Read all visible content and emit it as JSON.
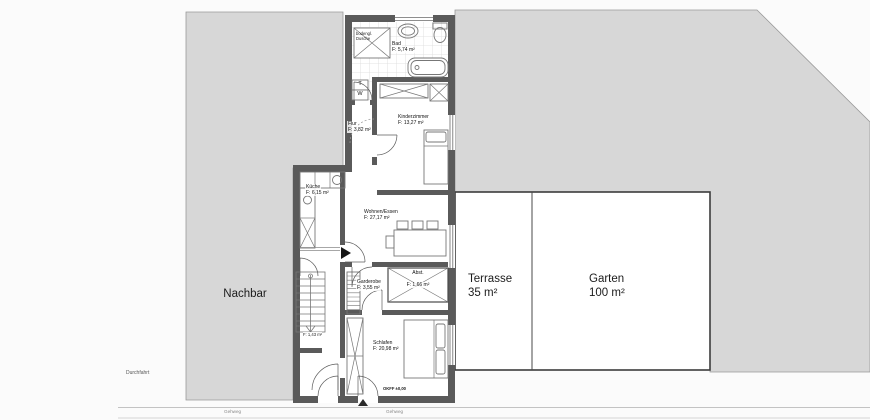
{
  "plan": {
    "zones": {
      "nachbar": {
        "label": "Nachbar"
      },
      "terrasse": {
        "label": "Terrasse",
        "area": "35 m²"
      },
      "garten": {
        "label": "Garten",
        "area": "100 m²"
      },
      "durchfahrt": {
        "label": "Durchfahrt"
      },
      "gehweg_left": {
        "label": "Gehweg"
      },
      "gehweg_right": {
        "label": "Gehweg"
      }
    },
    "rooms": {
      "bad": {
        "name": "Bad",
        "area": "F: 5,74 m²"
      },
      "kinderzimmer": {
        "name": "Kinderzimmer",
        "area": "F: 13,27 m²"
      },
      "flur": {
        "name": "Flur",
        "area": "F: 3,82 m²"
      },
      "kueche": {
        "name": "Küche",
        "area": "F: 6,15 m²"
      },
      "wohnen_essen": {
        "name": "Wohnen/Essen",
        "area": "F: 27,17 m²"
      },
      "garderobe": {
        "name": "Garderobe",
        "area": "F: 3,55 m²"
      },
      "abstellraum": {
        "name": "Abst.",
        "area": "F: 1,66 m²"
      },
      "schlafen": {
        "name": "Schlafen",
        "area": "F: 20,98 m²"
      },
      "nische": {
        "area": "F: 1,43 m²"
      },
      "dusche": {
        "line1": "bodengl.",
        "line2": "Dusche"
      }
    },
    "appliances": {
      "trockner": "T",
      "waschmaschine": "W"
    },
    "annotations": {
      "floor_level": "OKFF ±0,00"
    },
    "colors": {
      "wall": "#5a5a5a",
      "neighbor_fill": "#d7d7d7",
      "outline": "#8e8e8e",
      "background": "#fbfbfb"
    }
  }
}
